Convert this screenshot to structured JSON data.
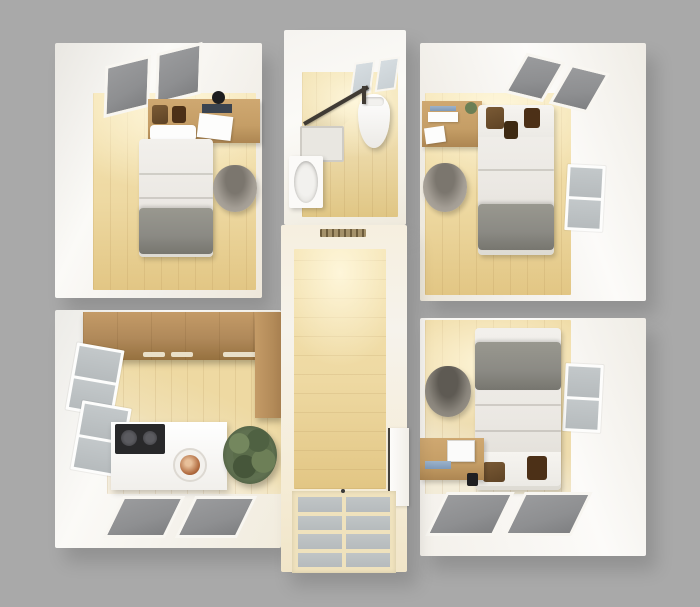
{
  "scene": {
    "description": "3D rendered top-down floor plan of a small apartment with three bedrooms, bathroom, kitchen and central hallway",
    "view": "birds-eye dollhouse render",
    "background_color": "#a9a9a9"
  },
  "colors": {
    "bg": "#a9a9a9",
    "wall": "#f2efe9",
    "wallhi": "#fbfaf7",
    "cream": "#f5ecd7",
    "wood": "#eed9a2",
    "wood2": "#e2c684",
    "tan": "#ecd9a8",
    "cab": "#b0895a",
    "desk": "#c59e66",
    "linen": "#ebe8e3",
    "blanket": "#8b8a84",
    "chair": "#a39d94",
    "chairdark": "#7b766e",
    "sky": "#8e8f91",
    "skyblue": "#c9d0d4",
    "pane": "#b6bbbd",
    "frame": "#efe2bd",
    "plant": "#5a6c4a",
    "cushion": "#5e4325",
    "shower": "#403b34",
    "washer": "#b06a3e",
    "cooktop": "#28282a"
  },
  "rooms": {
    "bedroom_top_left": {
      "items": [
        "ceiling-skylight",
        "headboard-shelf",
        "pillows",
        "laptop",
        "papers",
        "single-bed",
        "gray-blanket",
        "desk-chair"
      ]
    },
    "bathroom": {
      "items": [
        "ceiling-skylight",
        "corner-shower",
        "toilet",
        "sink-vanity"
      ]
    },
    "bedroom_top_right": {
      "items": [
        "ceiling-skylight",
        "wall-desk",
        "papers",
        "small-plant",
        "desk-chair",
        "single-bed",
        "gray-blanket",
        "right-window"
      ]
    },
    "bedroom_bottom_right": {
      "items": [
        "single-bed",
        "gray-blanket",
        "pillows",
        "desk-chair",
        "wall-desk",
        "laptop",
        "speaker",
        "right-window",
        "floor-skylights"
      ]
    },
    "kitchen": {
      "items": [
        "upper-cabinet-run",
        "corner-cabinet",
        "left-windows",
        "counter",
        "cooktop",
        "washing-machine",
        "plant",
        "floor-skylights"
      ]
    },
    "hallway": {
      "items": [
        "air-vent",
        "wood-floor",
        "right-door",
        "paned-balcony-window"
      ]
    }
  }
}
